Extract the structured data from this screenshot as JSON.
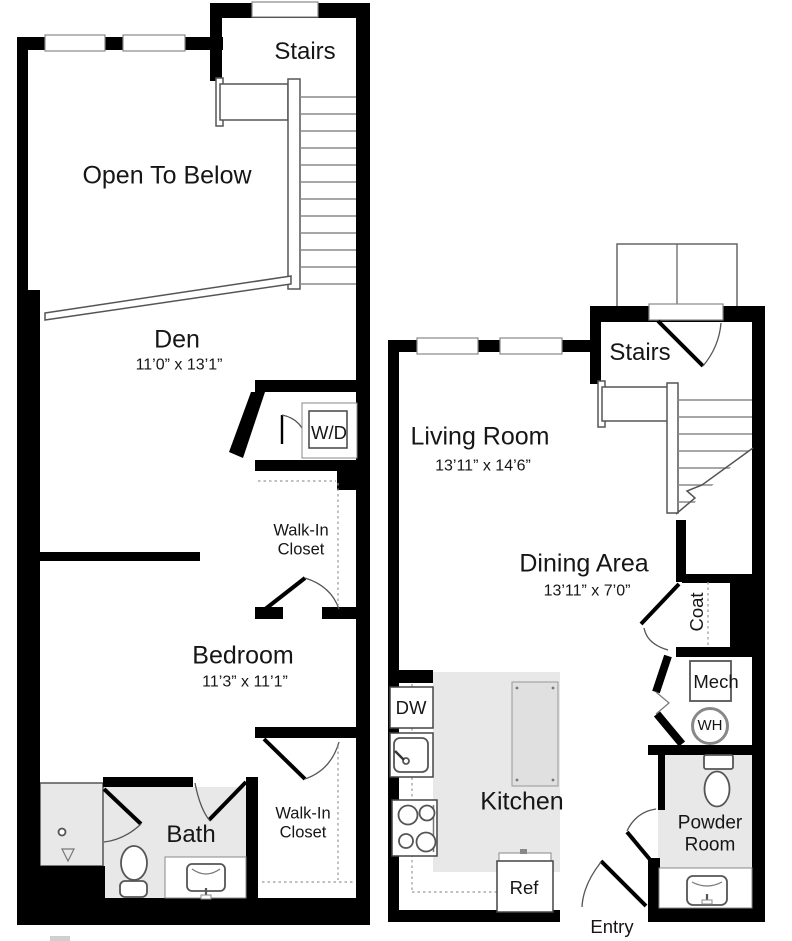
{
  "colors": {
    "wall": "#000000",
    "shaded_fill": "#e8e8e8",
    "tread": "#8a8a8a",
    "text": "#161616"
  },
  "upper_unit": {
    "stairs_label": "Stairs",
    "open_to_below_label": "Open To Below",
    "den": {
      "name": "Den",
      "dims": "11’0” x 13’1”"
    },
    "washer_dryer_label": "W/D",
    "walk_in_closet_upper": {
      "line1": "Walk-In",
      "line2": "Closet"
    },
    "bedroom": {
      "name": "Bedroom",
      "dims": "11’3” x 11’1”"
    },
    "bath_label": "Bath",
    "walk_in_closet_lower": {
      "line1": "Walk-In",
      "line2": "Closet"
    }
  },
  "main_unit": {
    "stairs_label": "Stairs",
    "living_room": {
      "name": "Living Room",
      "dims": "13’11” x 14’6”"
    },
    "dining_area": {
      "name": "Dining Area",
      "dims": "13’11” x 7’0”"
    },
    "coat_label": "Coat",
    "mech_label": "Mech",
    "water_heater_label": "WH",
    "dishwasher_label": "DW",
    "kitchen_label": "Kitchen",
    "refrigerator_label": "Ref",
    "entry_label": "Entry",
    "powder_room": {
      "line1": "Powder",
      "line2": "Room"
    }
  }
}
